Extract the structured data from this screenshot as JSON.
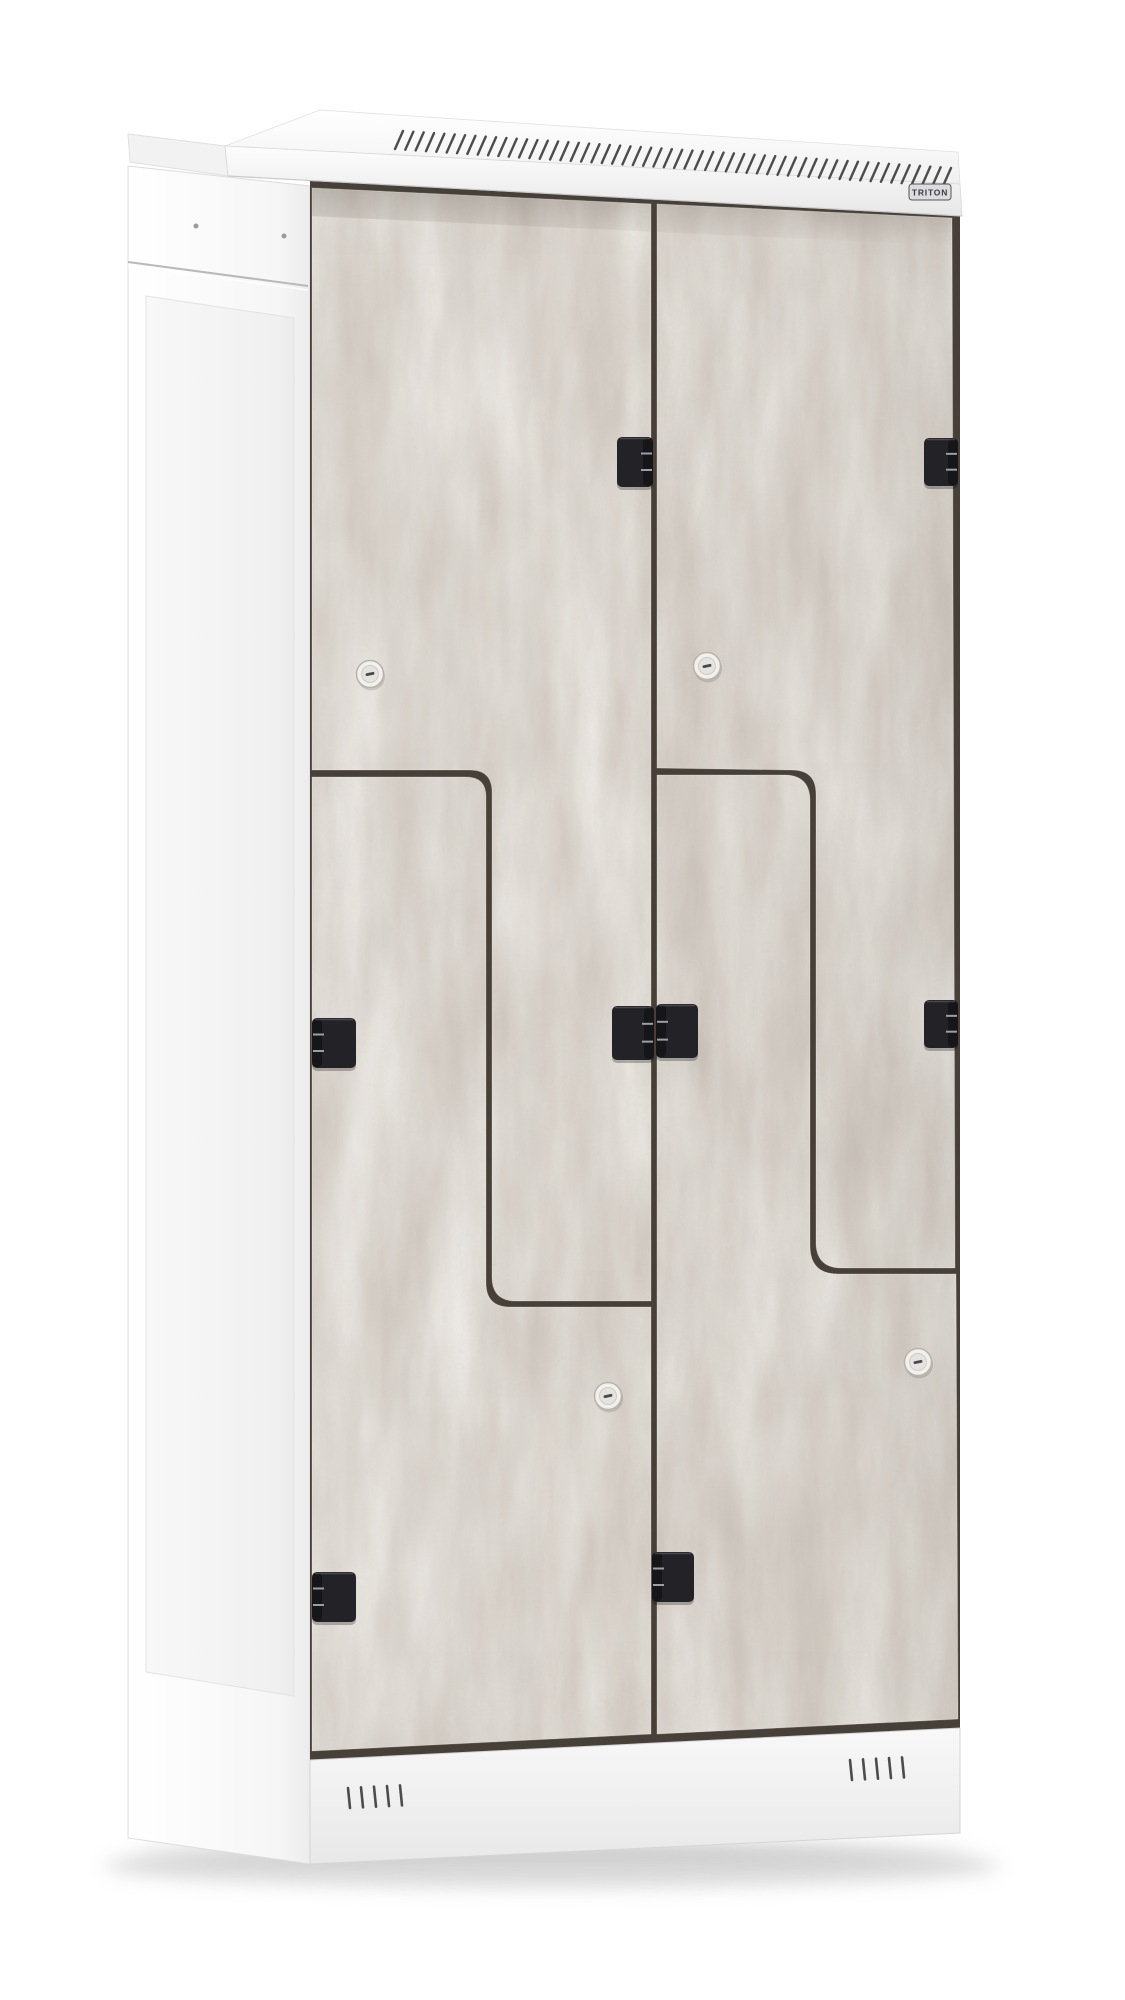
{
  "subject": "Double Z-door locker cabinet, white steel body with concrete-finish doors",
  "brand_badge": {
    "label": "TRITON"
  },
  "locker": {
    "door_columns": 2,
    "doors_total": 4,
    "locks_visible": 4,
    "hinges_visible": 7,
    "top_vent_slots": 54,
    "bottom_vent_groups": 2,
    "slots_per_bottom_group": 5,
    "door_finish": "concrete grey",
    "body_finish": "white"
  },
  "colors": {
    "background": "#ffffff",
    "cabinet_body": "#f6f6f6",
    "door_base": "#c9c1b8",
    "door_light": "#ddd7cf",
    "door_dark": "#a9a196",
    "cut_gap": "#474038",
    "hinge_black": "#232327",
    "hinge_knuckle": "#9aa0a8",
    "lock_face": "#f2f0ec",
    "lock_slot": "#4a4a4a",
    "vent_slot": "#4c4c4c",
    "badge_plate": "#dcdcdf",
    "badge_text": "#3b3b41",
    "floor_shadow": "#bdbdbd"
  }
}
